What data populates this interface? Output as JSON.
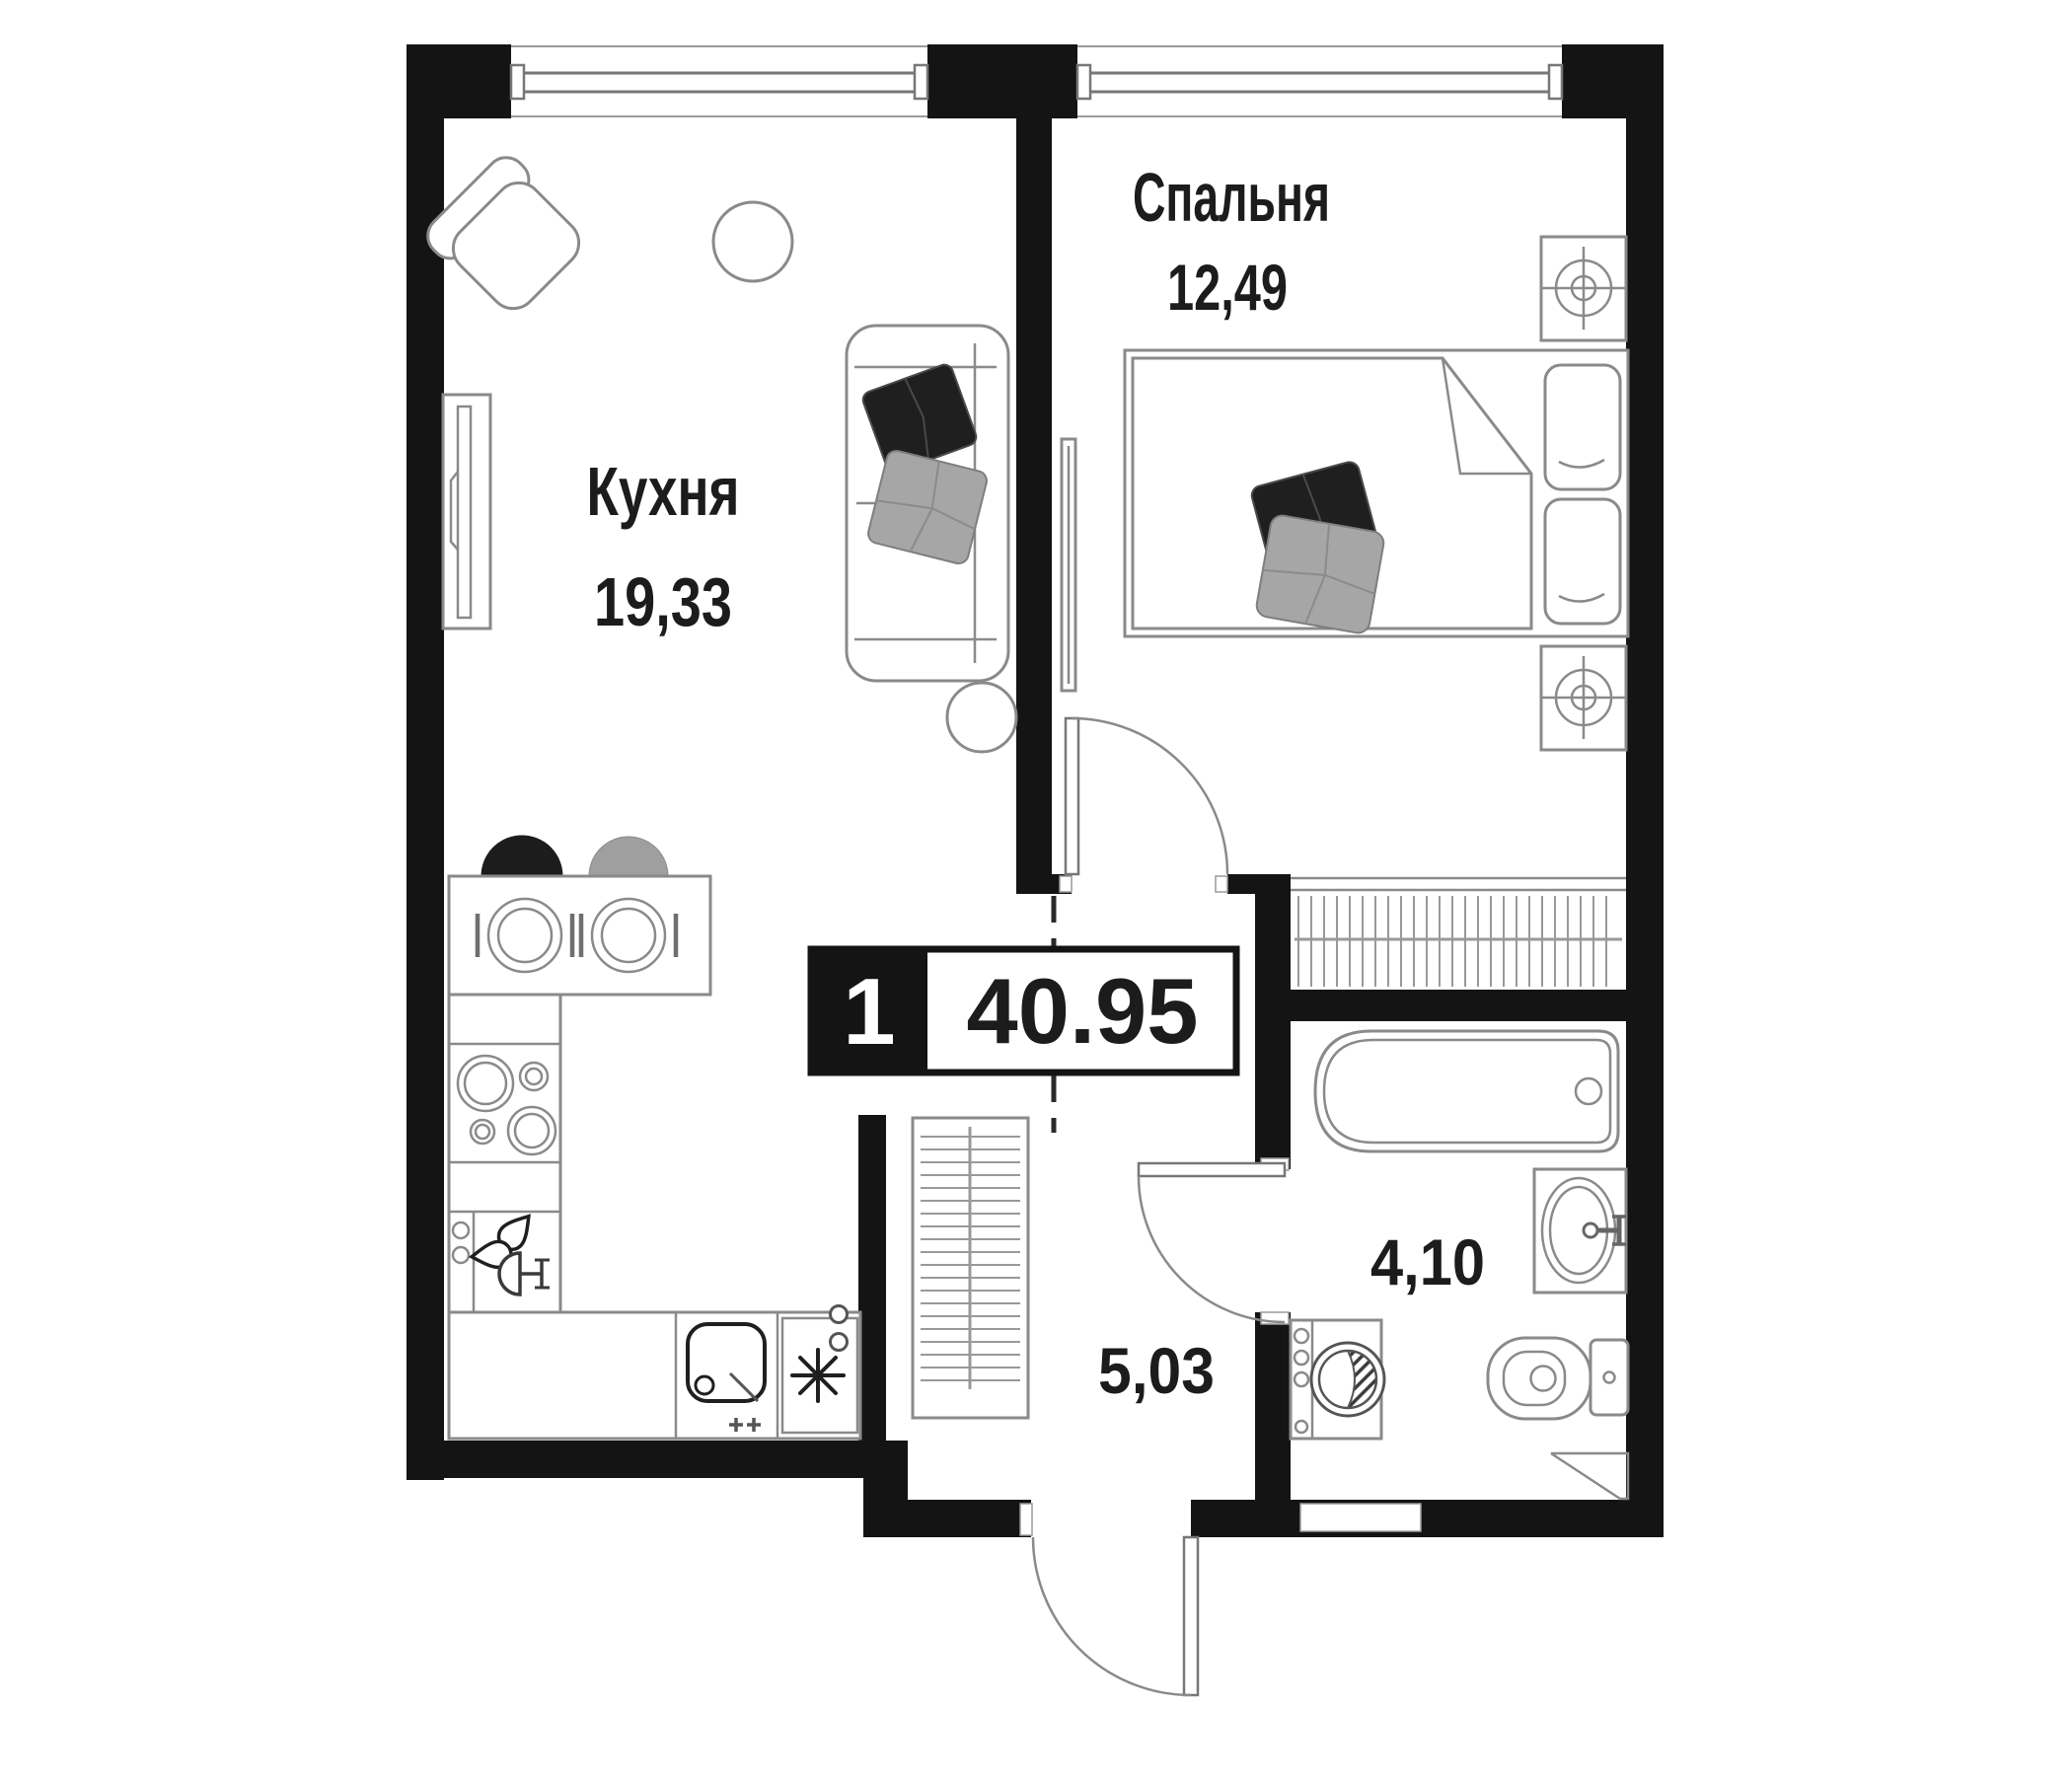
{
  "plan_type": "apartment-floor-plan",
  "labels": {
    "kitchen_name": "Кухня",
    "kitchen_area": "19,33",
    "bedroom_name": "Спальня",
    "bedroom_area": "12,49",
    "bathroom_area": "4,10",
    "hallway_area": "5,03",
    "badge_rooms": "1",
    "badge_total_area": "40.95"
  },
  "colors": {
    "wall": "#141414",
    "furniture_stroke": "#8a8a8a",
    "pillow_dark": "#1f1f1f",
    "pillow_gray": "#a6a6a6",
    "stool_black": "#1c1c1c",
    "stool_gray": "#9f9f9f",
    "text": "#1c1c1c"
  }
}
